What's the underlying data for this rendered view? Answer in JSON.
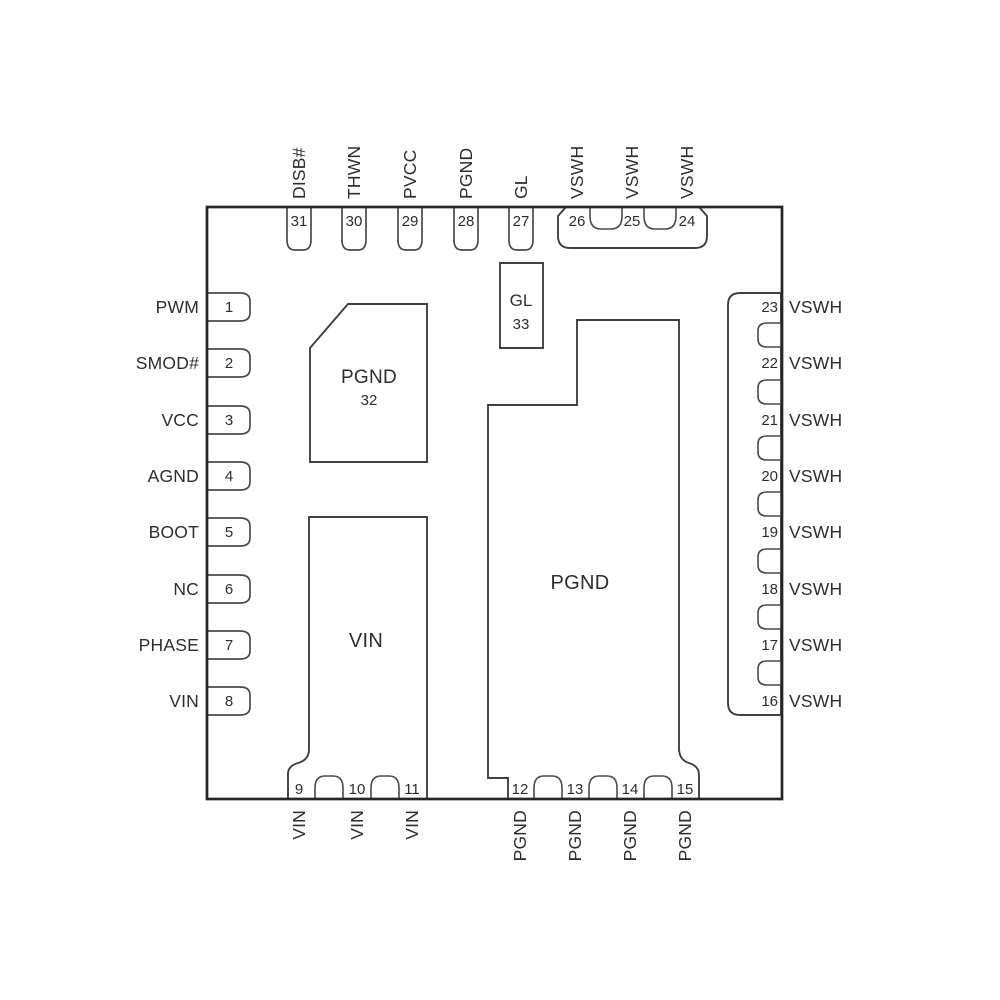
{
  "diagram": {
    "pins_left": [
      {
        "num": "1",
        "name": "PWM"
      },
      {
        "num": "2",
        "name": "SMOD#"
      },
      {
        "num": "3",
        "name": "VCC"
      },
      {
        "num": "4",
        "name": "AGND"
      },
      {
        "num": "5",
        "name": "BOOT"
      },
      {
        "num": "6",
        "name": "NC"
      },
      {
        "num": "7",
        "name": "PHASE"
      },
      {
        "num": "8",
        "name": "VIN"
      }
    ],
    "pins_top": [
      {
        "num": "31",
        "name": "DISB#"
      },
      {
        "num": "30",
        "name": "THWN"
      },
      {
        "num": "29",
        "name": "PVCC"
      },
      {
        "num": "28",
        "name": "PGND"
      },
      {
        "num": "27",
        "name": "GL"
      },
      {
        "num": "26",
        "name": "VSWH"
      },
      {
        "num": "25",
        "name": "VSWH"
      },
      {
        "num": "24",
        "name": "VSWH"
      }
    ],
    "pins_right": [
      {
        "num": "23",
        "name": "VSWH"
      },
      {
        "num": "22",
        "name": "VSWH"
      },
      {
        "num": "21",
        "name": "VSWH"
      },
      {
        "num": "20",
        "name": "VSWH"
      },
      {
        "num": "19",
        "name": "VSWH"
      },
      {
        "num": "18",
        "name": "VSWH"
      },
      {
        "num": "17",
        "name": "VSWH"
      },
      {
        "num": "16",
        "name": "VSWH"
      }
    ],
    "pins_bottom": [
      {
        "num": "9",
        "name": "VIN"
      },
      {
        "num": "10",
        "name": "VIN"
      },
      {
        "num": "11",
        "name": "VIN"
      },
      {
        "num": "12",
        "name": "PGND"
      },
      {
        "num": "13",
        "name": "PGND"
      },
      {
        "num": "14",
        "name": "PGND"
      },
      {
        "num": "15",
        "name": "PGND"
      }
    ],
    "center_pads": {
      "pgnd32": {
        "name": "PGND",
        "num": "32"
      },
      "gl33": {
        "name": "GL",
        "num": "33"
      },
      "vin": {
        "name": "VIN"
      },
      "pgnd": {
        "name": "PGND"
      }
    },
    "colors": {
      "background": "#ffffff",
      "package_line": "#262626",
      "pin_line": "#4a4a4a",
      "text": "#2d2d2d"
    }
  }
}
